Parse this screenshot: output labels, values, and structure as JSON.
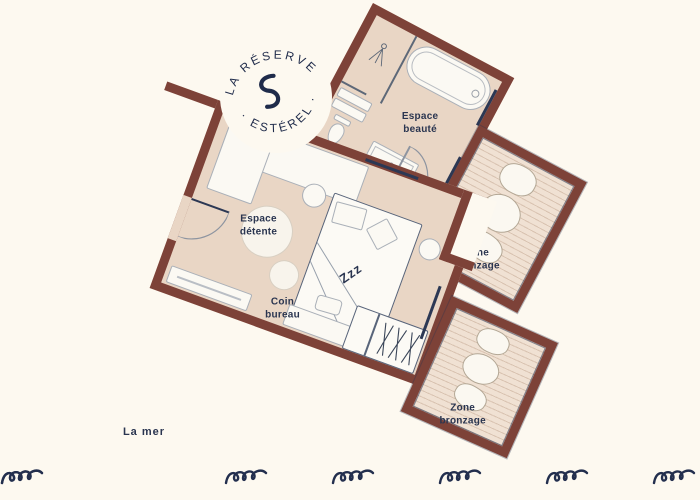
{
  "colors": {
    "background": "#fdf9f0",
    "wall": "#7d4238",
    "floor": "#e9d6c5",
    "deck": "#f0e1d3",
    "text_navy": "#2a3550"
  },
  "logo": {
    "arc_top": "LA RÉSERVE",
    "arc_bottom": "· ESTÉREL ·",
    "center_icon": "wave-s-icon"
  },
  "labels": {
    "beauty": [
      "Espace",
      "beauté"
    ],
    "relax": [
      "Espace",
      "détente"
    ],
    "office": [
      "Coin",
      "bureau"
    ],
    "tan_top": [
      "Zone",
      "bronzage"
    ],
    "tan_bottom": [
      "Zone",
      "bronzage"
    ],
    "bed": "Zzz",
    "sea": "La mer"
  },
  "icons": {
    "center": "wave-s-icon",
    "waves": "wave-icon",
    "shower": "shower-icon",
    "hangers": "hangers-icon"
  },
  "wave_count": 7
}
